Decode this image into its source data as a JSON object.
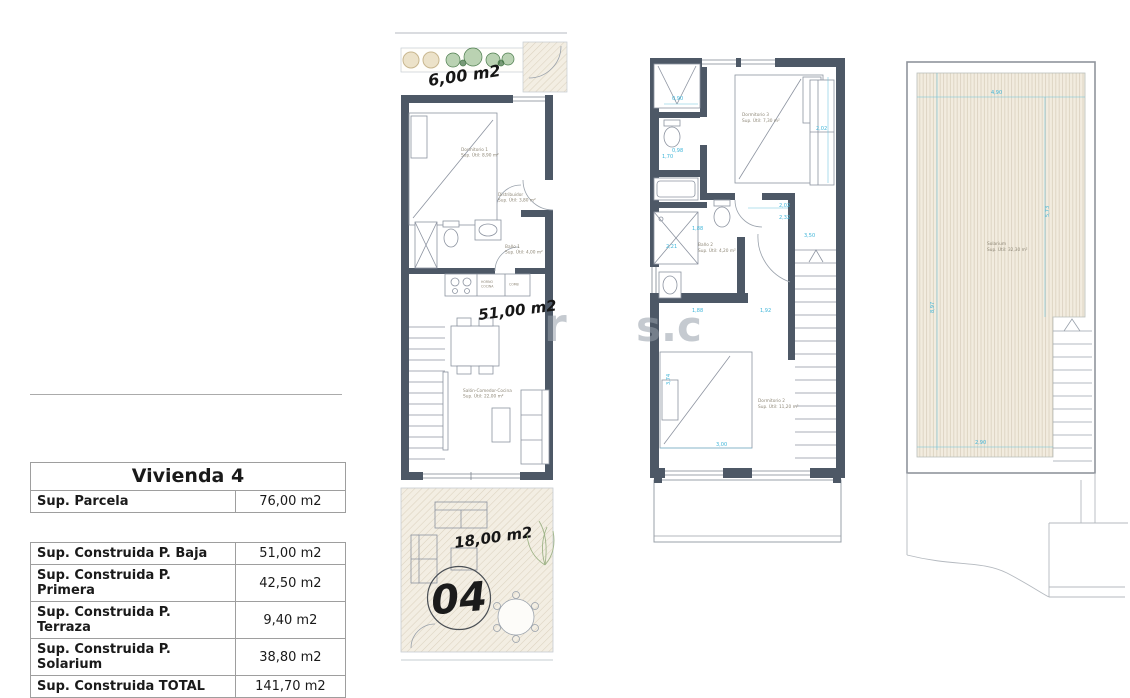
{
  "table": {
    "title": "Vivienda 4",
    "parcela": {
      "label": "Sup. Parcela",
      "value": "76,00 m2"
    },
    "rows": [
      {
        "label": "Sup. Construida P. Baja",
        "value": "51,00 m2"
      },
      {
        "label": "Sup. Construida P. Primera",
        "value": "42,50 m2"
      },
      {
        "label": "Sup. Construida P. Terraza",
        "value": "9,40 m2"
      },
      {
        "label": "Sup. Construida P. Solarium",
        "value": "38,80 m2"
      },
      {
        "label": "Sup. Construida TOTAL",
        "value": "141,70 m2"
      }
    ]
  },
  "plans": {
    "baja": {
      "garden_area": "6,00 m2",
      "built_area": "51,00 m2",
      "terrace_area": "18,00 m2",
      "unit_number": "04",
      "labels": {
        "dorm1_l1": "Dormitorio 1",
        "dorm1_l2": "Sup. Útil: 8,90 m²",
        "distrib_l1": "Distribuidor",
        "distrib_l2": "Sup. Útil: 3,80 m²",
        "bano1_l1": "Baño 1",
        "bano1_l2": "Sup. Útil: 4,00 m²",
        "salon_l1": "Salón-Comedor-Cocina",
        "salon_l2": "Sup. Útil: 22,00 m²",
        "horno_l1": "HORNO",
        "horno_l2": "COCINA",
        "comb": "COMB"
      }
    },
    "primera": {
      "labels": {
        "dorm3_l1": "Dormitorio 3",
        "dorm3_l2": "Sup. Útil: 7,30 m²",
        "bano2_l1": "Baño 2",
        "bano2_l2": "Sup. Útil: 4,20 m²",
        "dorm2_l1": "Dormitorio 2",
        "dorm2_l2": "Sup. Útil: 11,20 m²",
        "terraza_l1": "Terraza",
        "terraza_l2": "Sup. Útil: 6,60 m²"
      },
      "dims": {
        "a": "0,90",
        "b": "0,98",
        "c": "1,70",
        "d": "1,88",
        "e": "2,21",
        "f": "2,02",
        "g": "2,32",
        "h": "3,50",
        "i": "1,88",
        "j": "1,92",
        "k": "2,02",
        "l": "3,74",
        "m": "3,00",
        "n": "4,15",
        "o": "1,78"
      }
    },
    "solarium": {
      "labels": {
        "sol_l1": "Solarium",
        "sol_l2": "Sup. Útil: 32,30 m²"
      },
      "dims": {
        "top": "4,90",
        "right": "5,73",
        "left": "8,97",
        "bottom": "2,90"
      }
    }
  },
  "watermark": {
    "part1": "r",
    "part2": "s.c"
  },
  "colors": {
    "wall": "#4d5866",
    "dimension": "#3db4d8",
    "hatch_bg": "#f2ecdf",
    "hatch_line": "#d9d0bd",
    "room_label": "#8f8878"
  }
}
